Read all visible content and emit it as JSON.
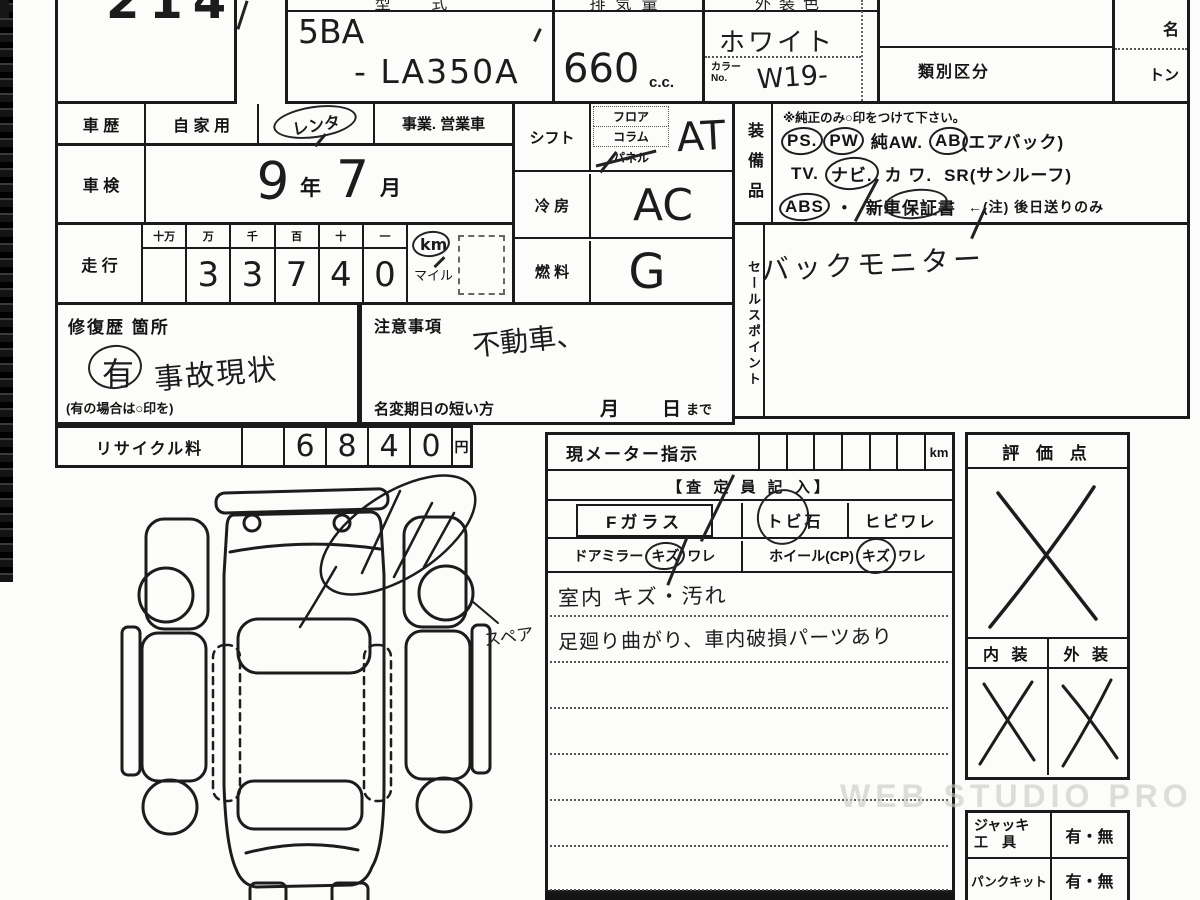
{
  "sheet": {
    "stock_no": "2147",
    "watermark": "WEB STUDIO PRO"
  },
  "header": {
    "type_label": "型 式",
    "type_value_1": "5BA",
    "type_value_2": "- LA350A",
    "disp_label": "排気量",
    "disp_value": "660",
    "disp_unit": "c.c.",
    "color_label": "外装色",
    "color_value": "ホワイト",
    "color_no_label1": "カラー",
    "color_no_label2": "No.",
    "color_no_value": "W19-",
    "class_label": "類別区分",
    "name_label": "名",
    "ton_label": "トン"
  },
  "history": {
    "label": "車 歴",
    "opt_private": "自 家 用",
    "opt_rental": "レンタ",
    "opt_business": "事業. 営業車"
  },
  "inspection": {
    "label": "車 検",
    "year": "9",
    "year_unit": "年",
    "month": "7",
    "month_unit": "月"
  },
  "mileage": {
    "label": "走 行",
    "headers": [
      "十万",
      "万",
      "千",
      "百",
      "十",
      "一"
    ],
    "digits": [
      "",
      "3",
      "3",
      "7",
      "4",
      "0"
    ],
    "km": "km",
    "mile": "マイル"
  },
  "shift": {
    "label": "シフト",
    "opt1": "フロア",
    "opt2": "コラム",
    "opt3": "パネル",
    "value": "AT"
  },
  "cooling": {
    "label": "冷 房",
    "value": "AC"
  },
  "fuel": {
    "label": "燃 料",
    "value": "G"
  },
  "equipment": {
    "label": "装備品",
    "note": "※純正のみ○印をつけて下さい。",
    "ps": "PS.",
    "pw": "PW",
    "aw": "純AW.",
    "ab": "AB",
    "ab_note": "(エアバック)",
    "tv": "TV.",
    "navi": "ナビ.",
    "kawa": "カ ワ.",
    "sr": "SR(サンルーフ)",
    "abs": "ABS",
    "dot": "・",
    "warranty": "新車保証書",
    "warranty_note": "←(注) 後日送りのみ"
  },
  "sales": {
    "label": "セールスポイント",
    "value": "バックモニター"
  },
  "repair": {
    "label": "修復歴 箇所",
    "mark": "有",
    "value": "事故現状",
    "hint": "(有の場合は○印を)"
  },
  "caution": {
    "label": "注意事項",
    "value": "不動車、"
  },
  "rename": {
    "label": "名変期日の短い方",
    "month": "月",
    "day": "日",
    "until": "まで"
  },
  "recycle": {
    "label": "リサイクル料",
    "digits": [
      "6",
      "8",
      "4",
      "0"
    ],
    "unit": "円"
  },
  "meter": {
    "label": "現メーター指示",
    "unit": "km"
  },
  "assessor": {
    "header": "【査 定 員 記 入】",
    "f_glass": "Fガラス",
    "stone": "トビ石",
    "crack": "ヒビワレ",
    "mirror_label": "ドアミラー",
    "mirror_opt1": "キズ",
    "mirror_opt2": "ワレ",
    "wheel_label": "ホイール(CP)",
    "wheel_opt1": "キズ",
    "wheel_opt2": "ワレ"
  },
  "notes": {
    "line1": "室内 キズ・汚れ",
    "line2": "足廻り曲がり、車内破損パーツあり"
  },
  "evaluation": {
    "label": "評 価 点",
    "interior": "内 装",
    "exterior": "外 装"
  },
  "tools": {
    "jack1": "ジャッキ",
    "jack2": "工　具",
    "jack_value": "有・無",
    "kit": "パンクキット",
    "kit_value": "有・無"
  },
  "diagram": {
    "annotation": "スペア"
  }
}
